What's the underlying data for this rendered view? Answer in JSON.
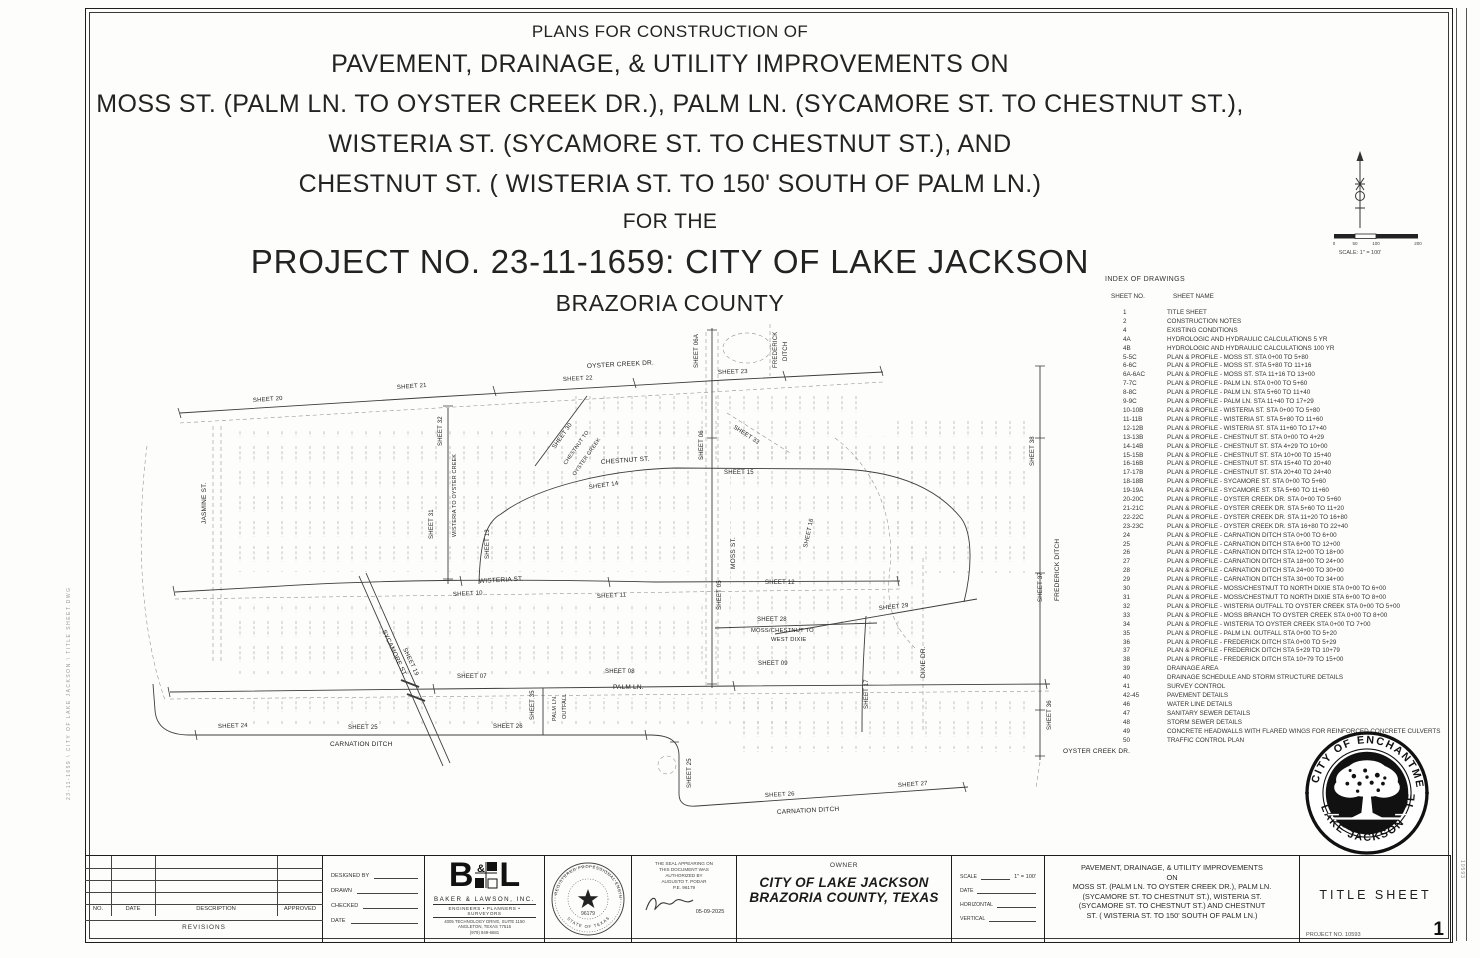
{
  "header": {
    "l1": "PLANS FOR CONSTRUCTION OF",
    "l2": "PAVEMENT, DRAINAGE, & UTILITY IMPROVEMENTS ON",
    "l3": "MOSS ST. (PALM LN. TO OYSTER CREEK DR.), PALM LN. (SYCAMORE ST. TO CHESTNUT ST.),",
    "l4": "WISTERIA ST. (SYCAMORE ST. TO CHESTNUT ST.), AND",
    "l5": "CHESTNUT ST. ( WISTERIA ST. TO 150' SOUTH OF PALM LN.)",
    "l6": "FOR THE",
    "l7": "PROJECT NO. 23-11-1659: CITY  OF  LAKE JACKSON",
    "l8": "BRAZORIA COUNTY"
  },
  "north_scale": {
    "caption": "SCALE: 1\" = 100'",
    "ticks": [
      "0",
      "50",
      "100",
      "200"
    ],
    "tick_x": [
      2,
      23,
      44,
      86
    ]
  },
  "index": {
    "title": "INDEX OF DRAWINGS",
    "col_no": "SHEET NO.",
    "col_name": "SHEET NAME",
    "rows": [
      {
        "no": "1",
        "name": "TITLE SHEET"
      },
      {
        "no": "2",
        "name": "CONSTRUCTION NOTES"
      },
      {
        "no": "",
        "name": ""
      },
      {
        "no": "",
        "name": ""
      },
      {
        "no": "4",
        "name": "EXISTING CONDITIONS"
      },
      {
        "no": "4A",
        "name": "HYDROLOGIC AND HYDRAULIC CALCULATIONS 5 YR"
      },
      {
        "no": "4B",
        "name": "HYDROLOGIC AND HYDRAULIC CALCULATIONS 100 YR"
      },
      {
        "no": "5-5C",
        "name": "PLAN & PROFILE - MOSS ST. STA 0+00 TO 5+80"
      },
      {
        "no": "6-6C",
        "name": "PLAN & PROFILE - MOSS ST. STA 5+80 TO 11+16"
      },
      {
        "no": "6A-6AC",
        "name": "PLAN & PROFILE - MOSS ST. STA 11+16 TO 13+00"
      },
      {
        "no": "7-7C",
        "name": "PLAN & PROFILE - PALM LN. STA 0+00 TO 5+60"
      },
      {
        "no": "8-8C",
        "name": "PLAN & PROFILE - PALM LN. STA 5+60 TO 11+40"
      },
      {
        "no": "9-9C",
        "name": "PLAN & PROFILE - PALM LN. STA 11+40 TO 17+29"
      },
      {
        "no": "10-10B",
        "name": "PLAN & PROFILE - WISTERIA ST. STA 0+00 TO 5+80"
      },
      {
        "no": "11-11B",
        "name": "PLAN & PROFILE - WISTERIA ST. STA 5+80 TO 11+60"
      },
      {
        "no": "12-12B",
        "name": "PLAN & PROFILE - WISTERIA ST. STA 11+60 TO 17+40"
      },
      {
        "no": "13-13B",
        "name": "PLAN & PROFILE - CHESTNUT ST. STA 0+00 TO 4+29"
      },
      {
        "no": "14-14B",
        "name": "PLAN & PROFILE - CHESTNUT ST. STA 4+29 TO 10+00"
      },
      {
        "no": "15-15B",
        "name": "PLAN & PROFILE - CHESTNUT ST. STA 10+00 TO 15+40"
      },
      {
        "no": "16-16B",
        "name": "PLAN & PROFILE - CHESTNUT ST. STA 15+40 TO 20+40"
      },
      {
        "no": "17-17B",
        "name": "PLAN & PROFILE - CHESTNUT ST. STA 20+40 TO 24+40"
      },
      {
        "no": "18-18B",
        "name": "PLAN & PROFILE - SYCAMORE ST. STA 0+00 TO 5+60"
      },
      {
        "no": "19-19A",
        "name": "PLAN & PROFILE - SYCAMORE ST. STA 5+60 TO 11+60"
      },
      {
        "no": "20-20C",
        "name": "PLAN & PROFILE - OYSTER CREEK DR. STA 0+00 TO 5+60"
      },
      {
        "no": "21-21C",
        "name": "PLAN & PROFILE - OYSTER CREEK DR. STA 5+60 TO 11+20"
      },
      {
        "no": "22-22C",
        "name": "PLAN & PROFILE - OYSTER CREEK DR. STA 11+20 TO 16+80"
      },
      {
        "no": "23-23C",
        "name": "PLAN & PROFILE - OYSTER CREEK DR. STA 16+80 TO 22+40"
      },
      {
        "no": "24",
        "name": "PLAN & PROFILE - CARNATION DITCH STA 0+00 TO 6+00"
      },
      {
        "no": "25",
        "name": "PLAN & PROFILE - CARNATION DITCH STA 6+00 TO 12+00"
      },
      {
        "no": "26",
        "name": "PLAN & PROFILE - CARNATION DITCH STA 12+00 TO 18+00"
      },
      {
        "no": "27",
        "name": "PLAN & PROFILE - CARNATION DITCH STA 18+00 TO 24+00"
      },
      {
        "no": "28",
        "name": "PLAN & PROFILE - CARNATION DITCH STA 24+00 TO 30+00"
      },
      {
        "no": "29",
        "name": "PLAN & PROFILE - CARNATION DITCH STA 30+00 TO 34+00"
      },
      {
        "no": "30",
        "name": "PLAN & PROFILE - MOSS/CHESTNUT TO NORTH DIXIE STA 0+00 TO 6+00"
      },
      {
        "no": "31",
        "name": "PLAN & PROFILE - MOSS/CHESTNUT TO NORTH DIXIE STA 6+00 TO 8+00"
      },
      {
        "no": "32",
        "name": "PLAN & PROFILE - WISTERIA OUTFALL TO OYSTER CREEK STA 0+00 TO 5+00"
      },
      {
        "no": "33",
        "name": "PLAN & PROFILE - MOSS BRANCH TO OYSTER CREEK STA 0+00 TO 8+00"
      },
      {
        "no": "34",
        "name": "PLAN & PROFILE - WISTERIA TO OYSTER CREEK STA 0+00 TO 7+00"
      },
      {
        "no": "35",
        "name": "PLAN & PROFILE - PALM LN. OUTFALL STA 0+00 TO 5+20"
      },
      {
        "no": "36",
        "name": "PLAN & PROFILE - FREDERICK DITCH STA 0+00 TO 5+29"
      },
      {
        "no": "37",
        "name": "PLAN & PROFILE - FREDERICK DITCH STA 5+29 TO 10+79"
      },
      {
        "no": "38",
        "name": "PLAN & PROFILE - FREDERICK DITCH STA 10+79 TO 15+00"
      },
      {
        "no": "39",
        "name": "DRAINAGE AREA"
      },
      {
        "no": "40",
        "name": "DRAINAGE SCHEDULE AND STORM STRUCTURE DETAILS"
      },
      {
        "no": "41",
        "name": "SURVEY CONTROL"
      },
      {
        "no": "42-45",
        "name": "PAVEMENT DETAILS"
      },
      {
        "no": "46",
        "name": "WATER LINE DETAILS"
      },
      {
        "no": "47",
        "name": "SANITARY SEWER DETAILS"
      },
      {
        "no": "48",
        "name": "STORM SEWER DETAILS"
      },
      {
        "no": "49",
        "name": "CONCRETE HEADWALLS WITH FLARED WINGS FOR REINFORCED CONCRETE CULVERTS"
      },
      {
        "no": "50",
        "name": "TRAFFIC CONTROL PLAN"
      }
    ]
  },
  "map": {
    "labels": [
      {
        "t": "SHEET 20",
        "x": 118,
        "y": 84,
        "r": -4,
        "s": 6
      },
      {
        "t": "SHEET 21",
        "x": 262,
        "y": 71,
        "r": -4,
        "s": 6
      },
      {
        "t": "SHEET 22",
        "x": 428,
        "y": 63,
        "r": -3,
        "s": 6
      },
      {
        "t": "OYSTER CREEK DR.",
        "x": 452,
        "y": 50,
        "r": -3,
        "s": 6.5
      },
      {
        "t": "SHEET 23",
        "x": 583,
        "y": 56,
        "r": -2,
        "s": 6
      },
      {
        "t": "SHEET 06A",
        "x": 563,
        "y": 50,
        "r": -90,
        "s": 6
      },
      {
        "t": "FREDERICK",
        "x": 642,
        "y": 50,
        "r": -90,
        "s": 6
      },
      {
        "t": "DITCH",
        "x": 652,
        "y": 43,
        "r": -90,
        "s": 6
      },
      {
        "t": "SHEET 06",
        "x": 568,
        "y": 142,
        "r": -90,
        "s": 6
      },
      {
        "t": "SHEET 32",
        "x": 307,
        "y": 128,
        "r": -90,
        "s": 6
      },
      {
        "t": "WISTERIA TO OYSTER CREEK",
        "x": 321,
        "y": 219,
        "r": -90,
        "s": 5.4
      },
      {
        "t": "SHEET 31",
        "x": 298,
        "y": 221,
        "r": -90,
        "s": 6
      },
      {
        "t": "JASMINE ST.",
        "x": 71,
        "y": 206,
        "r": -90,
        "s": 6.5
      },
      {
        "t": "SHEET 30",
        "x": 420,
        "y": 131,
        "r": -55,
        "s": 6
      },
      {
        "t": "CHESTNUT TO",
        "x": 431,
        "y": 147,
        "r": -55,
        "s": 5.4
      },
      {
        "t": "OYSTER CREEK",
        "x": 440,
        "y": 158,
        "r": -55,
        "s": 5.4
      },
      {
        "t": "SHEET 33",
        "x": 598,
        "y": 110,
        "r": 33,
        "s": 6
      },
      {
        "t": "CHESTNUT ST.",
        "x": 466,
        "y": 146,
        "r": -4,
        "s": 6.5
      },
      {
        "t": "SHEET 14",
        "x": 454,
        "y": 171,
        "r": -8,
        "s": 6
      },
      {
        "t": "SHEET 15",
        "x": 589,
        "y": 156,
        "r": 0,
        "s": 6
      },
      {
        "t": "SHEET 13",
        "x": 354,
        "y": 241,
        "r": -90,
        "s": 6
      },
      {
        "t": "SHEET 16",
        "x": 672,
        "y": 230,
        "r": -78,
        "s": 6
      },
      {
        "t": "MOSS ST.",
        "x": 600,
        "y": 251,
        "r": -90,
        "s": 6.5
      },
      {
        "t": "SHEET 05",
        "x": 586,
        "y": 292,
        "r": -90,
        "s": 6
      },
      {
        "t": "WISTERIA ST.",
        "x": 344,
        "y": 265,
        "r": -3,
        "s": 6.5
      },
      {
        "t": "SHEET 10",
        "x": 318,
        "y": 278,
        "r": -3,
        "s": 6
      },
      {
        "t": "SHEET 11",
        "x": 462,
        "y": 280,
        "r": -3,
        "s": 6
      },
      {
        "t": "SHEET 12",
        "x": 630,
        "y": 266,
        "r": 0,
        "s": 6
      },
      {
        "t": "SHEET 28",
        "x": 622,
        "y": 303,
        "r": 0,
        "s": 6
      },
      {
        "t": "MOSS/CHESTNUT TO",
        "x": 616,
        "y": 314,
        "r": 0,
        "s": 5.8
      },
      {
        "t": "WEST DIXIE",
        "x": 636,
        "y": 323,
        "r": 0,
        "s": 5.8
      },
      {
        "t": "SHEET 29",
        "x": 744,
        "y": 292,
        "r": -6,
        "s": 6
      },
      {
        "t": "DIXIE DR.",
        "x": 790,
        "y": 360,
        "r": -90,
        "s": 6.5
      },
      {
        "t": "SHEET 17",
        "x": 733,
        "y": 391,
        "r": -90,
        "s": 6
      },
      {
        "t": "SHEET 07",
        "x": 322,
        "y": 360,
        "r": 0,
        "s": 6
      },
      {
        "t": "SHEET 08",
        "x": 470,
        "y": 355,
        "r": 0,
        "s": 6
      },
      {
        "t": "PALM LN.",
        "x": 478,
        "y": 371,
        "r": 0,
        "s": 6.5
      },
      {
        "t": "SHEET 09",
        "x": 623,
        "y": 347,
        "r": 0,
        "s": 6
      },
      {
        "t": "SHEET 35",
        "x": 399,
        "y": 402,
        "r": -90,
        "s": 6
      },
      {
        "t": "PALM LN.",
        "x": 421,
        "y": 403,
        "r": -90,
        "s": 5.4
      },
      {
        "t": "OUTFALL",
        "x": 431,
        "y": 401,
        "r": -90,
        "s": 5.4
      },
      {
        "t": "SYCAMORE ST.",
        "x": 247,
        "y": 313,
        "r": 65,
        "s": 6.5
      },
      {
        "t": "SHEET 19",
        "x": 268,
        "y": 331,
        "r": 65,
        "s": 6
      },
      {
        "t": "SHEET 24",
        "x": 83,
        "y": 410,
        "r": -2,
        "s": 6
      },
      {
        "t": "SHEET 25",
        "x": 213,
        "y": 411,
        "r": 0,
        "s": 6
      },
      {
        "t": "SHEET 26",
        "x": 358,
        "y": 410,
        "r": 0,
        "s": 6
      },
      {
        "t": "CARNATION DITCH",
        "x": 195,
        "y": 428,
        "r": 0,
        "s": 6.5
      },
      {
        "t": "SHEET 25",
        "x": 556,
        "y": 470,
        "r": -90,
        "s": 6
      },
      {
        "t": "SHEET 26",
        "x": 630,
        "y": 479,
        "r": -3,
        "s": 6
      },
      {
        "t": "CARNATION DITCH",
        "x": 642,
        "y": 496,
        "r": -3,
        "s": 6.5
      },
      {
        "t": "SHEET 27",
        "x": 763,
        "y": 469,
        "r": -4,
        "s": 6
      },
      {
        "t": "SHEET 38",
        "x": 899,
        "y": 148,
        "r": -90,
        "s": 6
      },
      {
        "t": "FREDERICK DITCH",
        "x": 924,
        "y": 283,
        "r": -90,
        "s": 6.5
      },
      {
        "t": "SHEET 37",
        "x": 907,
        "y": 284,
        "r": -90,
        "s": 6
      },
      {
        "t": "SHEET 36",
        "x": 916,
        "y": 412,
        "r": -90,
        "s": 6
      },
      {
        "t": "OYSTER CREEK DR.",
        "x": 928,
        "y": 435,
        "r": 0,
        "s": 6.5
      }
    ]
  },
  "titleblock": {
    "revisions": {
      "no": "NO.",
      "date": "DATE",
      "description": "DESCRIPTION",
      "approved": "APPROVED",
      "caption": "REVISIONS"
    },
    "designed": {
      "rows": [
        "DESIGNED   BY",
        "DRAWN",
        "CHECKED",
        "DATE"
      ]
    },
    "firm": {
      "name": "BAKER & LAWSON, INC.",
      "tagline": "ENGINEERS • PLANNERS • SURVEYORS",
      "addr1": "4005 TECHNOLOGY DRIVE, SUITE 1150",
      "addr2": "ANGLETON, TEXAS 77515",
      "phone": "(979) 849-6681"
    },
    "pe_seal": {
      "ring_top": "REGISTERED PROFESSIONAL ENGINEER",
      "ring_bottom": "STATE OF TEXAS",
      "number": "96179"
    },
    "authorization": {
      "lines": [
        "THE SEAL APPEARING ON",
        "THIS DOCUMENT WAS",
        "AUTHORIZED BY",
        "AUGUSTO T. PODAR",
        "P.E. 96179"
      ],
      "date": "05-09-2025"
    },
    "owner": {
      "label": "OWNER",
      "name1": "CITY OF LAKE JACKSON",
      "name2": "BRAZORIA COUNTY, TEXAS"
    },
    "scales": {
      "rows": [
        {
          "l": "SCALE",
          "v": "1\" = 100'"
        },
        {
          "l": "DATE",
          "v": ""
        },
        {
          "l": "HORIZONTAL",
          "v": ""
        },
        {
          "l": "VERTICAL",
          "v": ""
        }
      ]
    },
    "project": {
      "lines": [
        "PAVEMENT, DRAINAGE, & UTILITY IMPROVEMENTS",
        "ON",
        "MOSS ST. (PALM LN. TO OYSTER CREEK DR.), PALM LN.",
        "(SYCAMORE ST. TO CHESTNUT ST.), WISTERIA ST.",
        "(SYCAMORE ST. TO CHESTNUT ST.)  AND CHESTNUT",
        "ST. ( WISTERIA ST. TO 150' SOUTH OF PALM LN.)"
      ]
    },
    "sheet": {
      "title": "TITLE  SHEET",
      "project_no": "PROJECT  NO.  10593",
      "number": "1"
    }
  },
  "city_seal": {
    "arc_top": "CITY OF ENCHANTMENT",
    "arc_bottom": "LAKE JACKSON · TEXAS"
  },
  "edge": {
    "left_stamp": "23-11-1659  \\  CITY OF LAKE JACKSON  \\  TITLE SHEET.DWG",
    "right_note": "10593"
  }
}
